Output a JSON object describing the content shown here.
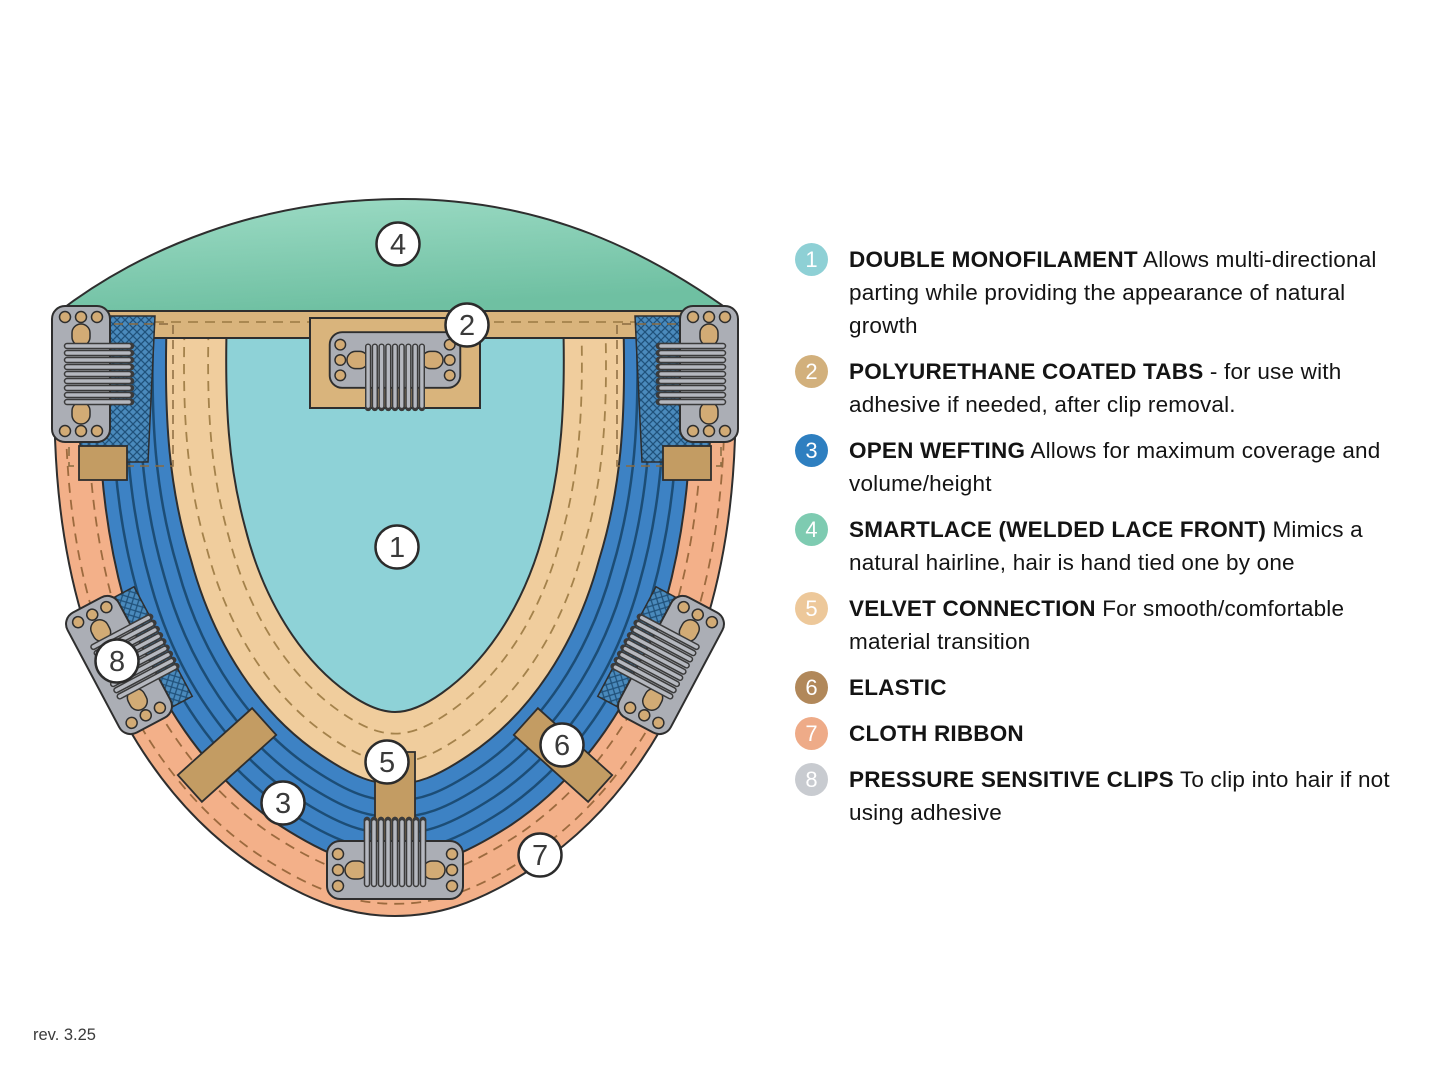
{
  "footer": {
    "revision": "rev. 3.25"
  },
  "diagram": {
    "callout_labels": [
      "1",
      "2",
      "3",
      "4",
      "5",
      "6",
      "7",
      "8"
    ],
    "colors": {
      "lace_light": "#9edcc6",
      "lace_dark": "#6fc0a2",
      "monofilament": "#8ed2d7",
      "wefting": "#3d82c4",
      "weft_line": "#1c4d76",
      "velvet": "#f0cd9d",
      "band": "#d9b47c",
      "elastic": "#c39c63",
      "ribbon": "#f3b089",
      "clip": "#abaeb5",
      "mesh": "#4a8abc"
    }
  },
  "legend": {
    "items": [
      {
        "num": "1",
        "color": "#8ed0d5",
        "title": "DOUBLE MONOFILAMENT",
        "desc": "Allows multi-directional parting while providing the appearance of natural growth"
      },
      {
        "num": "2",
        "color": "#d2b07c",
        "title": "POLYURETHANE COATED TABS",
        "desc": "- for use with adhesive if needed, after clip removal."
      },
      {
        "num": "3",
        "color": "#2e7fc0",
        "title": "OPEN WEFTING",
        "desc": "Allows for maximum coverage and volume/height"
      },
      {
        "num": "4",
        "color": "#7ecbb1",
        "title": "SMARTLACE (WELDED LACE FRONT)",
        "desc": "Mimics a natural hairline, hair is hand tied one by one"
      },
      {
        "num": "5",
        "color": "#edc89a",
        "title": "VELVET CONNECTION",
        "desc": "For smooth/comfortable material transition"
      },
      {
        "num": "6",
        "color": "#b1885a",
        "title": "ELASTIC",
        "desc": ""
      },
      {
        "num": "7",
        "color": "#eeab88",
        "title": "CLOTH RIBBON",
        "desc": ""
      },
      {
        "num": "8",
        "color": "#c8cbd0",
        "title": "PRESSURE SENSITIVE CLIPS",
        "desc": "To clip into hair if not using adhesive"
      }
    ]
  }
}
